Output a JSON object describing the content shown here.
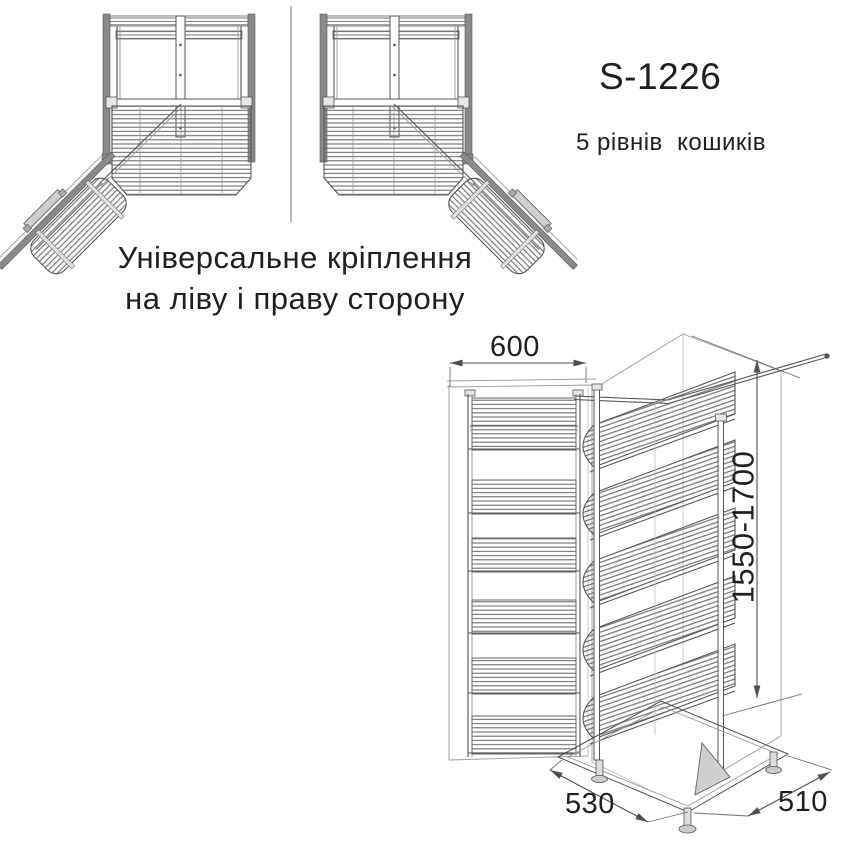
{
  "title_block": {
    "model": "S-1226",
    "subtitle": "5 рівнів  кошиків"
  },
  "mounting_note": {
    "line1": "Універсальне кріплення",
    "line2": "на ліву і праву сторону"
  },
  "dimensions": {
    "cabinet_width": "600",
    "height_range": "1550-1700",
    "base_depth_left": "530",
    "base_depth_right": "510"
  },
  "colors": {
    "ink": "#1f1f1f",
    "line": "#4f4f4f",
    "panel": "#8a8a8a",
    "bg": "#ffffff"
  }
}
